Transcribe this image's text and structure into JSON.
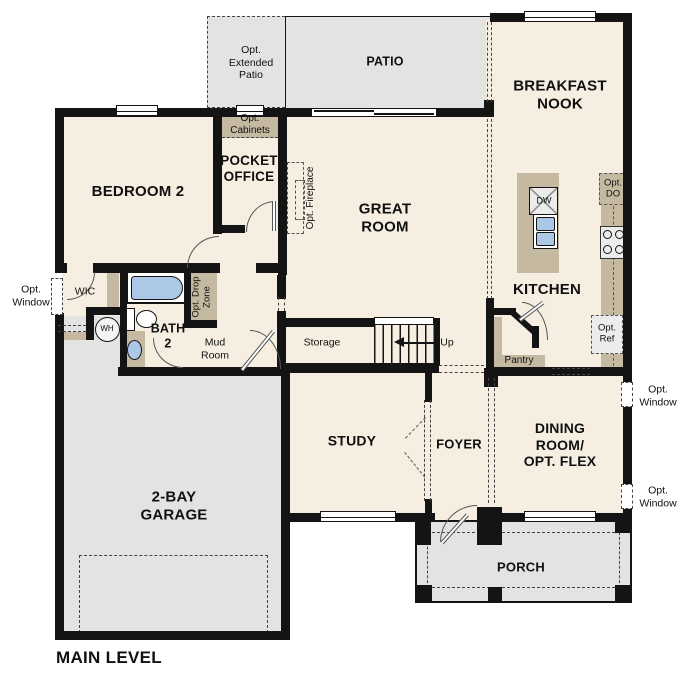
{
  "plan_title": "MAIN LEVEL",
  "colors": {
    "wall": "#141414",
    "floor": "#f5eee1",
    "outdoor": "#e3e3e1",
    "cabinet": "#c5b9a1",
    "fixture_blue": "#abc8e6",
    "appliance": "#ececec"
  },
  "rooms": {
    "bedroom2": "BEDROOM 2",
    "pocket_office": "POCKET\nOFFICE",
    "great_room": "GREAT\nROOM",
    "breakfast_nook": "BREAKFAST\nNOOK",
    "kitchen": "KITCHEN",
    "study": "STUDY",
    "foyer": "FOYER",
    "dining_flex": "DINING\nROOM/\nOPT. FLEX",
    "garage": "2-BAY\nGARAGE",
    "bath2": "BATH\n2",
    "wic": "WIC",
    "mud_room": "Mud\nRoom",
    "storage": "Storage",
    "pantry": "Pantry",
    "porch": "PORCH",
    "patio": "PATIO"
  },
  "options": {
    "extended_patio": "Opt.\nExtended\nPatio",
    "cabinets": "Opt.\nCabinets",
    "fireplace": "Opt. Fireplace",
    "drop_zone": "Opt. Drop\nZone",
    "window": "Opt.\nWindow",
    "double_oven": "Opt.\nDO",
    "refrigerator": "Opt.\nRef"
  },
  "annotations": {
    "stairs_up": "Up",
    "water_heater": "WH",
    "dishwasher": "DW"
  }
}
